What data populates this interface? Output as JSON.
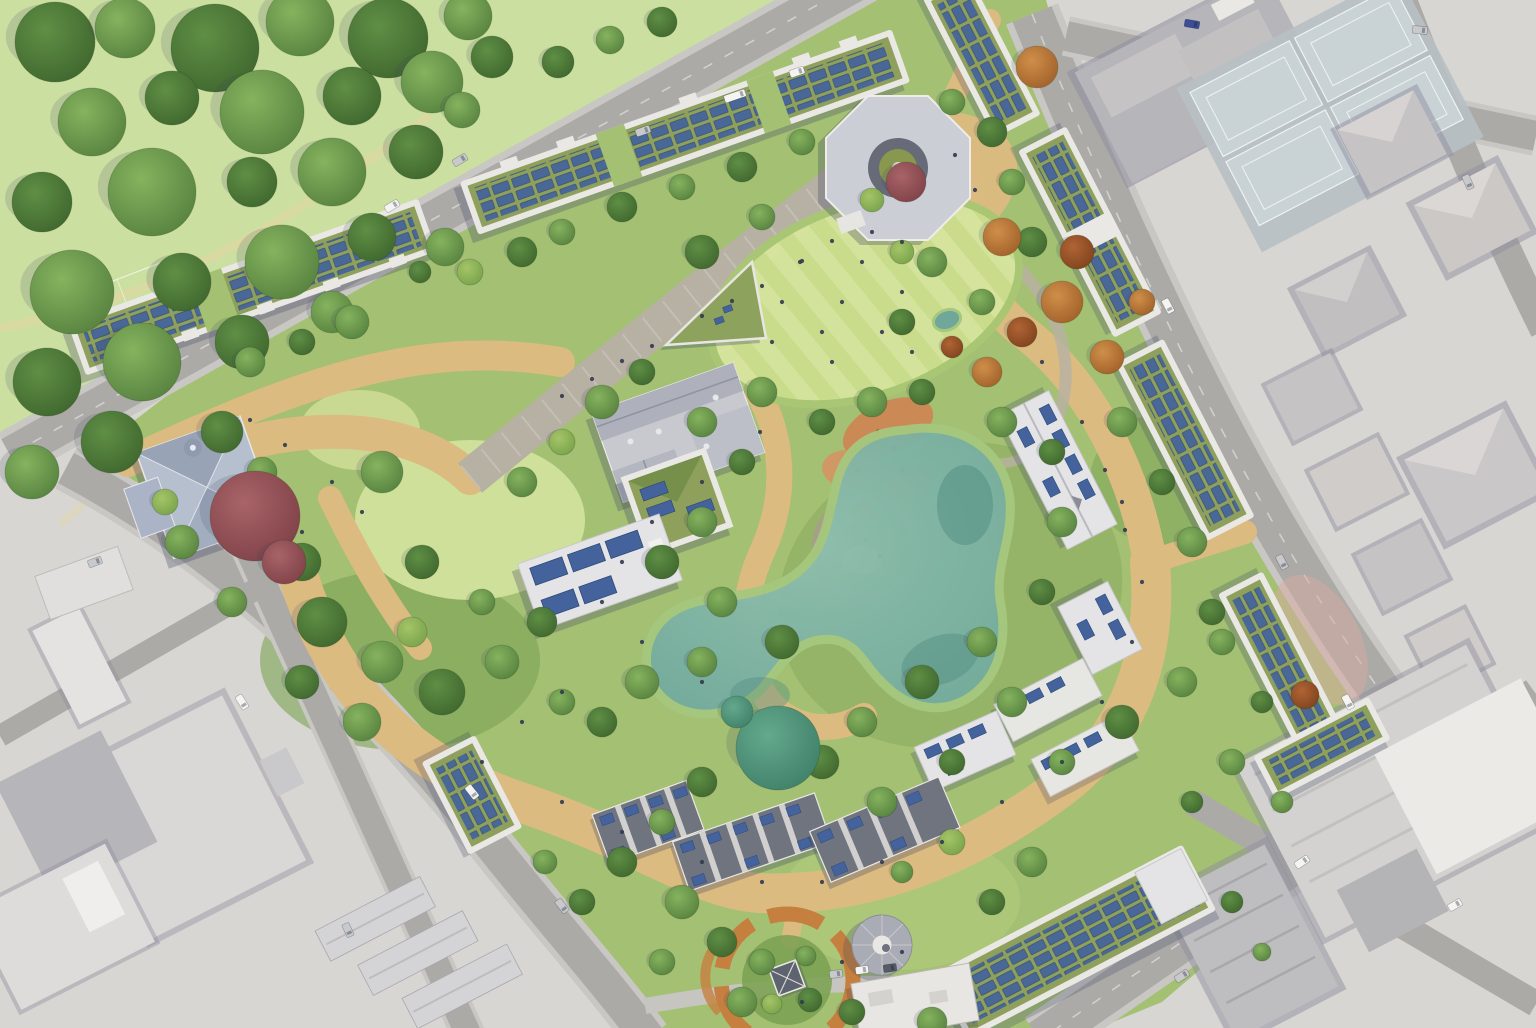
{
  "image": {
    "kind": "aerial-masterplan-rendering",
    "description": "Bird's-eye architectural masterplan rendering of a green urban redevelopment block: perimeter housing with rooftop solar panels and green roofs around a large public park with lawns, winding paths, a wildlife pond, playground and circular garden; surrounded by desaturated grey city blocks, roads and a large public park at top-left",
    "width": 1536,
    "height": 1028
  },
  "legend": {
    "features": [
      {
        "name": "public-park",
        "note": "large tree-filled park, top-left"
      },
      {
        "name": "perimeter-building-green-roof-solar",
        "note": "long blocks with olive green roofs covered in blue photovoltaic arrays"
      },
      {
        "name": "central-lawn",
        "note": "striped mown event lawn"
      },
      {
        "name": "promenade",
        "note": "paved diagonal walkway"
      },
      {
        "name": "wildlife-pond",
        "note": "teal naturalistic pond with marsh edge"
      },
      {
        "name": "playground",
        "note": "orange safety-surface play areas"
      },
      {
        "name": "circular-garden",
        "note": "round garden with small pavilion"
      },
      {
        "name": "round-pavilion",
        "note": "grey circular roof structure"
      },
      {
        "name": "octagon-pavilion",
        "note": "octagonal building with circular courtyard"
      },
      {
        "name": "church",
        "note": "slate-roofed church with dark red tree"
      },
      {
        "name": "terraced-houses",
        "note": "rows of dark roofs with solar strips"
      },
      {
        "name": "tennis-courts",
        "note": "pale courts in grey city, top-right"
      },
      {
        "name": "city-blocks",
        "note": "desaturated surrounding context"
      }
    ]
  },
  "palette": {
    "city-base": "#d7d6d2",
    "road": "#abaaa7",
    "road-edge": "#c8c7c3",
    "road-line": "#f5f5f2",
    "lane": "#c6c5c0",
    "block-light": "#d9d8d6",
    "block-mid": "#c6c3c4",
    "block-dark": "#b6b5b9",
    "block-white": "#e9e8e5",
    "block-shadow": "#8f8d9e",
    "shadow": "#3c4260",
    "court-apron": "#b7c0c4",
    "court": "#c9d3d6",
    "court-line": "#eef2f2",
    "park": "#cbdfa1",
    "park-path": "#e4d5a2",
    "site-green": "#a3c073",
    "wood-green": "#7ca153",
    "wetland-green": "#8fae62",
    "meadow": "#cfe09a",
    "lawn-a": "#cadd8c",
    "lawn-b": "#d6e59e",
    "tan": "#dcbb80",
    "tan-light": "#e7cf9a",
    "promenade": "#b7b1a4",
    "pebble": "#b9b2a2",
    "pond": "#6fa89b",
    "pond-light": "#8fbfae",
    "pond-deep": "#4f8b80",
    "marsh": "#a6c77e",
    "play-orange": "#cf8352",
    "play-ring": "#a89e8c",
    "sand": "#dfc08d",
    "garden-ring": "#c5803f",
    "garden-green": "#7da253",
    "roof-parapet": "#e9e8e4",
    "roof-green": "#8ea05c",
    "solar": "#44639c",
    "solar-dark": "#2e4a78",
    "roof-gray": "#c7c9cf",
    "roof-gray-dark": "#aeb1bb",
    "roof-white": "#e4e4e6",
    "roof-terrace": "#70747f",
    "roof-church": "#b6bfce",
    "church-dark": "#98a3b6",
    "octagon": "#ccced6",
    "octagon-ring": "#666b77",
    "pavilion-gray": "#a9acb4",
    "pink-ground": "#d9a9a2",
    "car-white": "#f4f4f2",
    "car-silver": "#c7c9cc",
    "car-blue": "#3c4f96",
    "car-dark": "#565b64",
    "people": "#333950",
    "tree1a": "#86b35e",
    "tree1b": "#55813f",
    "tree2a": "#5f8f45",
    "tree2b": "#3f662e",
    "tree3a": "#a5c468",
    "tree3b": "#77a24a",
    "treeta": "#63a98d",
    "treetb": "#3f7f68",
    "treeaa": "#cf8f4a",
    "treeab": "#a05f28",
    "treeua": "#b06434",
    "treeub": "#7e421d",
    "treera": "#a86468",
    "treerb": "#7e4047"
  },
  "scene": {
    "trees": [
      [
        55,
        42,
        40,
        "2"
      ],
      [
        125,
        28,
        30,
        "1"
      ],
      [
        215,
        48,
        44,
        "2"
      ],
      [
        300,
        22,
        34,
        "1"
      ],
      [
        388,
        38,
        40,
        "2"
      ],
      [
        468,
        16,
        24,
        "1"
      ],
      [
        92,
        122,
        34,
        "1"
      ],
      [
        172,
        98,
        27,
        "2"
      ],
      [
        262,
        112,
        42,
        "1"
      ],
      [
        352,
        96,
        29,
        "2"
      ],
      [
        432,
        82,
        31,
        "1"
      ],
      [
        42,
        202,
        30,
        "2"
      ],
      [
        152,
        192,
        44,
        "1"
      ],
      [
        252,
        182,
        25,
        "2"
      ],
      [
        332,
        172,
        34,
        "1"
      ],
      [
        416,
        152,
        27,
        "2"
      ],
      [
        72,
        292,
        42,
        "1"
      ],
      [
        182,
        282,
        29,
        "2"
      ],
      [
        282,
        262,
        37,
        "1"
      ],
      [
        372,
        237,
        24,
        "2"
      ],
      [
        47,
        382,
        34,
        "2"
      ],
      [
        142,
        362,
        39,
        "1"
      ],
      [
        242,
        342,
        27,
        "2"
      ],
      [
        332,
        312,
        21,
        "1"
      ],
      [
        32,
        472,
        27,
        "1"
      ],
      [
        112,
        442,
        31,
        "2"
      ],
      [
        492,
        57,
        21,
        "2"
      ],
      [
        462,
        110,
        18,
        "1"
      ],
      [
        558,
        62,
        16,
        "2"
      ],
      [
        610,
        40,
        14,
        "1"
      ],
      [
        662,
        22,
        15,
        "2"
      ],
      [
        250,
        362,
        15,
        "1"
      ],
      [
        302,
        342,
        13,
        "2"
      ],
      [
        352,
        322,
        17,
        "1"
      ],
      [
        522,
        252,
        15,
        "2"
      ],
      [
        562,
        232,
        13,
        "1"
      ],
      [
        622,
        207,
        15,
        "2"
      ],
      [
        682,
        187,
        13,
        "1"
      ],
      [
        742,
        167,
        15,
        "2"
      ],
      [
        802,
        142,
        13,
        "1"
      ],
      [
        445,
        247,
        19,
        "1"
      ],
      [
        470,
        272,
        13,
        "3"
      ],
      [
        420,
        272,
        11,
        "2"
      ],
      [
        222,
        432,
        21,
        "2"
      ],
      [
        262,
        472,
        15,
        "1"
      ],
      [
        182,
        542,
        17,
        "1"
      ],
      [
        302,
        562,
        19,
        "2"
      ],
      [
        232,
        602,
        15,
        "1"
      ],
      [
        165,
        502,
        13,
        "3"
      ],
      [
        382,
        472,
        21,
        "1"
      ],
      [
        422,
        562,
        17,
        "2"
      ],
      [
        522,
        482,
        15,
        "1"
      ],
      [
        562,
        442,
        13,
        "3"
      ],
      [
        322,
        622,
        25,
        "2"
      ],
      [
        382,
        662,
        21,
        "1"
      ],
      [
        442,
        692,
        23,
        "2"
      ],
      [
        362,
        722,
        19,
        "1"
      ],
      [
        302,
        682,
        17,
        "2"
      ],
      [
        502,
        662,
        17,
        "1"
      ],
      [
        542,
        622,
        15,
        "2"
      ],
      [
        482,
        602,
        13,
        "1"
      ],
      [
        412,
        632,
        15,
        "3"
      ],
      [
        602,
        402,
        17,
        "1"
      ],
      [
        642,
        372,
        13,
        "2"
      ],
      [
        702,
        422,
        15,
        "1"
      ],
      [
        742,
        462,
        13,
        "2"
      ],
      [
        702,
        522,
        15,
        "1"
      ],
      [
        662,
        562,
        17,
        "2"
      ],
      [
        722,
        602,
        15,
        "1"
      ],
      [
        782,
        642,
        17,
        "2"
      ],
      [
        702,
        662,
        15,
        "1"
      ],
      [
        642,
        682,
        17,
        "1"
      ],
      [
        602,
        722,
        15,
        "2"
      ],
      [
        562,
        702,
        13,
        "1"
      ],
      [
        702,
        252,
        17,
        "2"
      ],
      [
        762,
        217,
        13,
        "1"
      ],
      [
        932,
        262,
        15,
        "1"
      ],
      [
        902,
        322,
        13,
        "2"
      ],
      [
        762,
        392,
        15,
        "1"
      ],
      [
        822,
        422,
        13,
        "2"
      ],
      [
        872,
        200,
        12,
        "3"
      ],
      [
        872,
        402,
        15,
        "1"
      ],
      [
        922,
        392,
        13,
        "2"
      ],
      [
        1002,
        422,
        15,
        "1"
      ],
      [
        1052,
        452,
        13,
        "2"
      ],
      [
        1062,
        522,
        15,
        "1"
      ],
      [
        1042,
        592,
        13,
        "2"
      ],
      [
        982,
        642,
        15,
        "1"
      ],
      [
        922,
        682,
        17,
        "2"
      ],
      [
        862,
        722,
        15,
        "1"
      ],
      [
        822,
        762,
        17,
        "2"
      ],
      [
        882,
        802,
        15,
        "1"
      ],
      [
        952,
        762,
        13,
        "2"
      ],
      [
        1012,
        702,
        15,
        "1"
      ],
      [
        1122,
        422,
        15,
        "1"
      ],
      [
        1162,
        482,
        13,
        "2"
      ],
      [
        1192,
        542,
        15,
        "1"
      ],
      [
        1212,
        612,
        13,
        "2"
      ],
      [
        1182,
        682,
        15,
        "1"
      ],
      [
        1122,
        722,
        17,
        "2"
      ],
      [
        1062,
        762,
        13,
        "1"
      ],
      [
        702,
        782,
        15,
        "2"
      ],
      [
        662,
        822,
        13,
        "1"
      ],
      [
        622,
        862,
        15,
        "2"
      ],
      [
        682,
        902,
        17,
        "1"
      ],
      [
        722,
        942,
        15,
        "2"
      ],
      [
        662,
        962,
        13,
        "1"
      ],
      [
        742,
        1002,
        15,
        "1"
      ],
      [
        852,
        1012,
        13,
        "2"
      ],
      [
        932,
        1022,
        15,
        "1"
      ],
      [
        992,
        902,
        13,
        "2"
      ],
      [
        1032,
        862,
        15,
        "1"
      ],
      [
        952,
        842,
        13,
        "3"
      ],
      [
        902,
        872,
        11,
        "1"
      ],
      [
        582,
        902,
        13,
        "2"
      ],
      [
        545,
        862,
        12,
        "1"
      ],
      [
        952,
        102,
        13,
        "1"
      ],
      [
        992,
        132,
        15,
        "2"
      ],
      [
        1012,
        182,
        13,
        "1"
      ],
      [
        1032,
        242,
        15,
        "2"
      ],
      [
        982,
        302,
        13,
        "1"
      ],
      [
        902,
        252,
        12,
        "3"
      ],
      [
        1222,
        642,
        13,
        "1"
      ],
      [
        1262,
        702,
        11,
        "2"
      ],
      [
        1232,
        762,
        13,
        "1"
      ],
      [
        1192,
        802,
        11,
        "2"
      ],
      [
        1282,
        802,
        11,
        "1"
      ],
      [
        1232,
        902,
        11,
        "2"
      ],
      [
        1262,
        952,
        9,
        "1"
      ],
      [
        762,
        962,
        13,
        "1"
      ],
      [
        810,
        1000,
        12,
        "2"
      ],
      [
        772,
        1004,
        10,
        "3"
      ],
      [
        806,
        956,
        10,
        "1"
      ],
      [
        778,
        748,
        42,
        "t"
      ],
      [
        737,
        712,
        16,
        "t"
      ],
      [
        1037,
        67,
        21,
        "a"
      ],
      [
        1002,
        237,
        19,
        "a"
      ],
      [
        1062,
        302,
        21,
        "a"
      ],
      [
        1107,
        357,
        17,
        "a"
      ],
      [
        987,
        372,
        15,
        "a"
      ],
      [
        1142,
        302,
        13,
        "a"
      ],
      [
        1077,
        252,
        17,
        "u"
      ],
      [
        1022,
        332,
        15,
        "u"
      ],
      [
        952,
        347,
        11,
        "u"
      ],
      [
        1305,
        695,
        14,
        "u"
      ],
      [
        255,
        516,
        45,
        "r"
      ],
      [
        284,
        562,
        22,
        "r"
      ],
      [
        906,
        182,
        20,
        "r"
      ]
    ],
    "cars": [
      [
        460,
        160,
        -31,
        "silver",
        15
      ],
      [
        392,
        206,
        -31,
        "white",
        15
      ],
      [
        735,
        96,
        -19,
        "white",
        22
      ],
      [
        643,
        131,
        -19,
        "silver",
        15
      ],
      [
        797,
        72,
        -19,
        "white",
        15
      ],
      [
        1192,
        24,
        10,
        "blue",
        15
      ],
      [
        1420,
        30,
        6,
        "silver",
        15
      ],
      [
        1468,
        182,
        66,
        "silver",
        15
      ],
      [
        1168,
        306,
        62,
        "white",
        15
      ],
      [
        1282,
        562,
        62,
        "silver",
        15
      ],
      [
        1348,
        702,
        62,
        "white",
        15
      ],
      [
        1302,
        862,
        -34,
        "white",
        15
      ],
      [
        1182,
        976,
        -34,
        "silver",
        15
      ],
      [
        472,
        792,
        52,
        "white",
        15
      ],
      [
        562,
        906,
        52,
        "silver",
        15
      ],
      [
        242,
        702,
        58,
        "white",
        15
      ],
      [
        95,
        562,
        -20,
        "silver",
        14
      ],
      [
        862,
        970,
        -8,
        "white",
        13
      ],
      [
        836,
        974,
        -8,
        "silver",
        13
      ],
      [
        890,
        968,
        -8,
        "dark",
        13
      ],
      [
        1455,
        905,
        -30,
        "white",
        14
      ],
      [
        348,
        930,
        65,
        "silver",
        14
      ]
    ],
    "people": [
      [
        562,
        396
      ],
      [
        592,
        379
      ],
      [
        622,
        361
      ],
      [
        652,
        346
      ],
      [
        702,
        316
      ],
      [
        732,
        301
      ],
      [
        762,
        286
      ],
      [
        802,
        261
      ],
      [
        832,
        241
      ],
      [
        760,
        432
      ],
      [
        702,
        482
      ],
      [
        652,
        522
      ],
      [
        622,
        562
      ],
      [
        602,
        602
      ],
      [
        642,
        642
      ],
      [
        702,
        682
      ],
      [
        562,
        692
      ],
      [
        522,
        722
      ],
      [
        482,
        762
      ],
      [
        562,
        802
      ],
      [
        622,
        832
      ],
      [
        702,
        862
      ],
      [
        762,
        882
      ],
      [
        822,
        882
      ],
      [
        882,
        862
      ],
      [
        942,
        842
      ],
      [
        1002,
        802
      ],
      [
        1062,
        762
      ],
      [
        1102,
        702
      ],
      [
        1132,
        642
      ],
      [
        1142,
        582
      ],
      [
        1122,
        502
      ],
      [
        1082,
        422
      ],
      [
        1042,
        362
      ],
      [
        332,
        482
      ],
      [
        362,
        512
      ],
      [
        302,
        532
      ],
      [
        842,
        962
      ],
      [
        802,
        1002
      ],
      [
        902,
        952
      ],
      [
        800,
        262
      ],
      [
        842,
        302
      ],
      [
        882,
        332
      ],
      [
        822,
        332
      ],
      [
        862,
        262
      ],
      [
        902,
        292
      ],
      [
        782,
        302
      ],
      [
        832,
        362
      ],
      [
        872,
        232
      ],
      [
        912,
        352
      ],
      [
        772,
        342
      ],
      [
        902,
        242
      ],
      [
        250,
        420
      ],
      [
        285,
        445
      ],
      [
        955,
        155
      ],
      [
        975,
        190
      ],
      [
        1105,
        470
      ],
      [
        1125,
        530
      ]
    ]
  }
}
